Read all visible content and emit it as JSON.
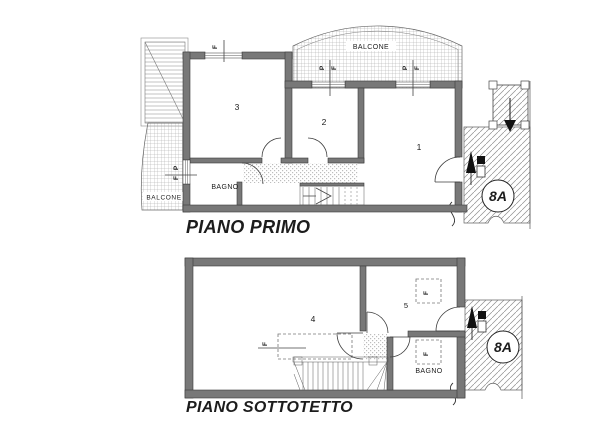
{
  "floor1": {
    "title": "PIANO PRIMO",
    "balcony_top": "BALCONE",
    "balcony_left": "BALCONE",
    "bathroom": "BAGNO",
    "room1": "1",
    "room2": "2",
    "room3": "3",
    "badge": "8A"
  },
  "floor2": {
    "title": "PIANO SOTTOTETTO",
    "bathroom": "BAGNO",
    "room4": "4",
    "room5": "5",
    "badge": "8A"
  },
  "markers": {
    "window": "F",
    "door": "P"
  },
  "colors": {
    "wall": "#787878",
    "line": "#3a3a3a",
    "hatch": "#9a9a9a",
    "paper": "#ffffff"
  }
}
